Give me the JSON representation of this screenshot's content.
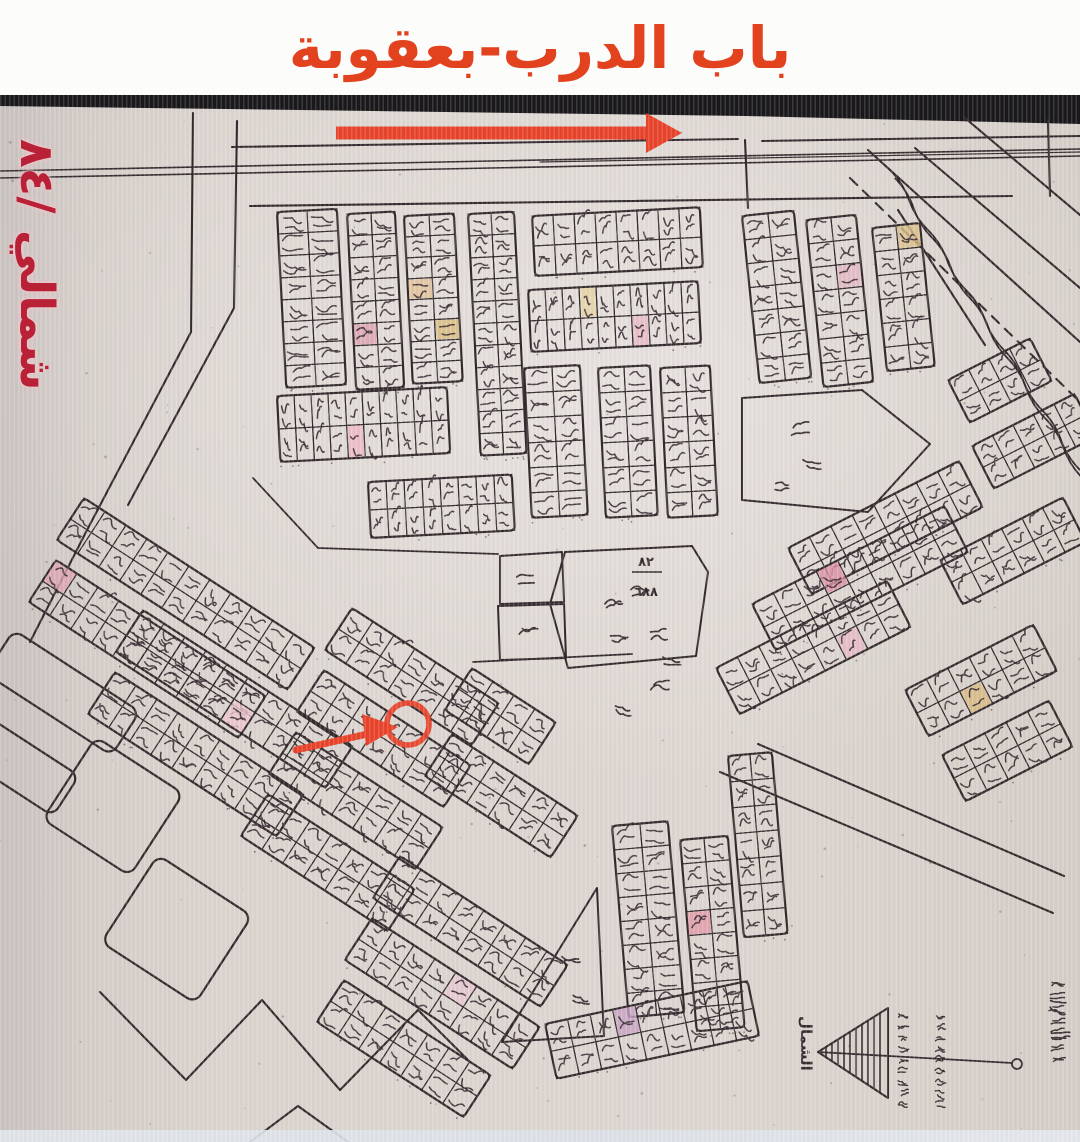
{
  "title": {
    "text": "باب الدرب-بعقوبة"
  },
  "side_label": {
    "text": "شمالي /٨٤"
  },
  "north": {
    "label": "الشمال"
  },
  "center_parcel": {
    "numerator": "٨٢",
    "denominator": "٦٨٨"
  },
  "palette": {
    "title_color": "#e2421e",
    "side_color": "#b92136",
    "annotation_red": "#e8432a",
    "ink": "#332a2d",
    "ink_soft": "#3d3036",
    "paper": "#d9d2cc",
    "top_band": "#19171a"
  },
  "map": {
    "top_band": [
      [
        0,
        95
      ],
      [
        1080,
        95
      ],
      [
        1080,
        124
      ],
      [
        745,
        116
      ],
      [
        0,
        106
      ]
    ],
    "roads": [
      {
        "p": [
          [
            232,
            147
          ],
          [
            738,
            139
          ]
        ]
      },
      {
        "p": [
          [
            762,
            141
          ],
          [
            1080,
            136
          ]
        ]
      },
      {
        "p": [
          [
            0,
            171
          ],
          [
            1080,
            149
          ]
        ],
        "w": 1.6
      },
      {
        "p": [
          [
            0,
            178
          ],
          [
            1080,
            156
          ]
        ],
        "w": 1.6
      },
      {
        "p": [
          [
            540,
            162
          ],
          [
            1080,
            152
          ]
        ],
        "w": 1.2
      },
      {
        "p": [
          [
            193,
            113
          ],
          [
            191,
            332
          ],
          [
            86,
            532
          ],
          [
            30,
            642
          ]
        ]
      },
      {
        "p": [
          [
            237,
            121
          ],
          [
            234,
            308
          ],
          [
            128,
            505
          ]
        ]
      },
      {
        "p": [
          [
            250,
            206
          ],
          [
            1012,
            196
          ]
        ]
      },
      {
        "p": [
          [
            745,
            140
          ],
          [
            748,
            208
          ]
        ]
      },
      {
        "p": [
          [
            1048,
            120
          ],
          [
            1050,
            196
          ]
        ]
      },
      {
        "p": [
          [
            898,
            210
          ],
          [
            985,
            345
          ]
        ]
      },
      {
        "p": [
          [
            868,
            150
          ],
          [
            1080,
            342
          ]
        ]
      },
      {
        "p": [
          [
            915,
            148
          ],
          [
            1080,
            288
          ]
        ]
      },
      {
        "p": [
          [
            965,
            118
          ],
          [
            1080,
            215
          ]
        ]
      },
      {
        "p": [
          [
            850,
            178
          ],
          [
            1080,
            402
          ]
        ],
        "dash": "10 8"
      },
      {
        "p": [
          [
            758,
            744
          ],
          [
            1064,
            876
          ]
        ]
      },
      {
        "p": [
          [
            720,
            772
          ],
          [
            1053,
            913
          ]
        ]
      },
      {
        "p": [
          [
            473,
            662
          ],
          [
            632,
            654
          ]
        ],
        "w": 1.8
      },
      {
        "p": [
          [
            253,
            478
          ],
          [
            318,
            548
          ],
          [
            498,
            554
          ]
        ],
        "w": 1.8
      },
      {
        "p": [
          [
            100,
            992
          ],
          [
            186,
            1080
          ],
          [
            262,
            1000
          ],
          [
            340,
            1090
          ],
          [
            418,
            1010
          ],
          [
            470,
            1062
          ]
        ]
      },
      {
        "p": [
          [
            250,
            1142
          ],
          [
            298,
            1106
          ],
          [
            348,
            1142
          ]
        ]
      }
    ],
    "canal": {
      "from": [
        890,
        170
      ],
      "to": [
        1080,
        470
      ],
      "gap": 8,
      "amp": 4,
      "waves": 10
    },
    "blocks": [
      {
        "x": 277,
        "y": 212,
        "c": 2,
        "r": 8,
        "cw": 30,
        "ch": 22,
        "a": -3
      },
      {
        "x": 347,
        "y": 214,
        "c": 2,
        "r": 8,
        "cw": 24,
        "ch": 22,
        "a": -3
      },
      {
        "x": 404,
        "y": 216,
        "c": 2,
        "r": 8,
        "cw": 25,
        "ch": 21,
        "a": -3
      },
      {
        "x": 468,
        "y": 214,
        "c": 2,
        "r": 11,
        "cw": 23,
        "ch": 22,
        "a": -3
      },
      {
        "x": 532,
        "y": 216,
        "c": 8,
        "r": 2,
        "cw": 21,
        "ch": 30,
        "a": -3
      },
      {
        "x": 528,
        "y": 290,
        "c": 10,
        "r": 2,
        "cw": 17,
        "ch": 31,
        "a": -3
      },
      {
        "x": 524,
        "y": 368,
        "c": 2,
        "r": 6,
        "cw": 28,
        "ch": 25,
        "a": -3
      },
      {
        "x": 598,
        "y": 368,
        "c": 2,
        "r": 6,
        "cw": 26,
        "ch": 25,
        "a": -3
      },
      {
        "x": 660,
        "y": 368,
        "c": 2,
        "r": 6,
        "cw": 25,
        "ch": 25,
        "a": -3
      },
      {
        "x": 277,
        "y": 396,
        "c": 10,
        "r": 2,
        "cw": 17,
        "ch": 33,
        "a": -3
      },
      {
        "x": 368,
        "y": 482,
        "c": 8,
        "r": 2,
        "cw": 18,
        "ch": 28,
        "a": -3
      },
      {
        "x": 742,
        "y": 216,
        "c": 2,
        "r": 7,
        "cw": 26,
        "ch": 24,
        "a": -6
      },
      {
        "x": 806,
        "y": 220,
        "c": 2,
        "r": 7,
        "cw": 25,
        "ch": 24,
        "a": -6
      },
      {
        "x": 872,
        "y": 228,
        "c": 2,
        "r": 6,
        "cw": 24,
        "ch": 24,
        "a": -6
      },
      {
        "x": 788,
        "y": 548,
        "c": 8,
        "r": 2,
        "cw": 24,
        "ch": 26,
        "a": -27
      },
      {
        "x": 752,
        "y": 604,
        "c": 9,
        "r": 2,
        "cw": 24,
        "ch": 26,
        "a": -27
      },
      {
        "x": 716,
        "y": 668,
        "c": 8,
        "r": 2,
        "cw": 24,
        "ch": 26,
        "a": -27
      },
      {
        "x": 940,
        "y": 560,
        "c": 6,
        "r": 2,
        "cw": 23,
        "ch": 25,
        "a": -27
      },
      {
        "x": 972,
        "y": 446,
        "c": 5,
        "r": 2,
        "cw": 23,
        "ch": 24,
        "a": -27
      },
      {
        "x": 905,
        "y": 690,
        "c": 6,
        "r": 2,
        "cw": 24,
        "ch": 26,
        "a": -27
      },
      {
        "x": 942,
        "y": 755,
        "c": 5,
        "r": 2,
        "cw": 24,
        "ch": 26,
        "a": -27
      },
      {
        "x": 84,
        "y": 498,
        "c": 11,
        "r": 2,
        "cw": 25,
        "ch": 25,
        "a": 33
      },
      {
        "x": 56,
        "y": 560,
        "c": 10,
        "r": 2,
        "cw": 25,
        "ch": 25,
        "a": 33
      },
      {
        "x": 143,
        "y": 610,
        "c": 10,
        "r": 2,
        "cw": 25,
        "ch": 25,
        "a": 33
      },
      {
        "x": 115,
        "y": 672,
        "c": 9,
        "r": 2,
        "cw": 25,
        "ch": 25,
        "a": 33
      },
      {
        "x": 352,
        "y": 608,
        "c": 7,
        "r": 2,
        "cw": 25,
        "ch": 25,
        "a": 33
      },
      {
        "x": 324,
        "y": 670,
        "c": 7,
        "r": 2,
        "cw": 25,
        "ch": 25,
        "a": 33
      },
      {
        "x": 296,
        "y": 732,
        "c": 7,
        "r": 2,
        "cw": 25,
        "ch": 25,
        "a": 33
      },
      {
        "x": 268,
        "y": 794,
        "c": 7,
        "r": 2,
        "cw": 25,
        "ch": 25,
        "a": 33
      },
      {
        "x": 472,
        "y": 668,
        "c": 4,
        "r": 2,
        "cw": 25,
        "ch": 25,
        "a": 33
      },
      {
        "x": 452,
        "y": 734,
        "c": 6,
        "r": 2,
        "cw": 25,
        "ch": 25,
        "a": 33
      },
      {
        "x": 400,
        "y": 856,
        "c": 8,
        "r": 2,
        "cw": 25,
        "ch": 25,
        "a": 33
      },
      {
        "x": 372,
        "y": 918,
        "c": 8,
        "r": 2,
        "cw": 25,
        "ch": 25,
        "a": 33
      },
      {
        "x": 344,
        "y": 980,
        "c": 7,
        "r": 2,
        "cw": 25,
        "ch": 25,
        "a": 33
      },
      {
        "x": 612,
        "y": 826,
        "c": 2,
        "r": 8,
        "cw": 28,
        "ch": 24,
        "a": -5
      },
      {
        "x": 680,
        "y": 840,
        "c": 2,
        "r": 8,
        "cw": 24,
        "ch": 24,
        "a": -5
      },
      {
        "x": 728,
        "y": 756,
        "c": 2,
        "r": 7,
        "cw": 22,
        "ch": 26,
        "a": -5
      },
      {
        "x": 545,
        "y": 1024,
        "c": 9,
        "r": 2,
        "cw": 23,
        "ch": 28,
        "a": -12
      },
      {
        "x": 948,
        "y": 380,
        "c": 4,
        "r": 2,
        "cw": 23,
        "ch": 24,
        "a": -27
      }
    ],
    "tints": [
      {
        "b": 1,
        "c": 0,
        "r": 5,
        "col": "#dfa3b0"
      },
      {
        "b": 2,
        "c": 1,
        "r": 5,
        "col": "#d9bd7e"
      },
      {
        "b": 2,
        "c": 0,
        "r": 3,
        "col": "#e2c398"
      },
      {
        "b": 5,
        "c": 3,
        "r": 0,
        "col": "#e6d5a4"
      },
      {
        "b": 5,
        "c": 6,
        "r": 1,
        "col": "#eab9c5"
      },
      {
        "b": 9,
        "c": 4,
        "r": 1,
        "col": "#efb9c6"
      },
      {
        "b": 12,
        "c": 1,
        "r": 2,
        "col": "#e4b9c3"
      },
      {
        "b": 13,
        "c": 1,
        "r": 0,
        "col": "#dcc08a"
      },
      {
        "b": 15,
        "c": 3,
        "r": 0,
        "col": "#dd8fa3"
      },
      {
        "b": 16,
        "c": 5,
        "r": 1,
        "col": "#e9bac6"
      },
      {
        "b": 19,
        "c": 2,
        "r": 1,
        "col": "#d9b97e"
      },
      {
        "b": 22,
        "c": 0,
        "r": 0,
        "col": "#dfa4b2"
      },
      {
        "b": 23,
        "c": 5,
        "r": 1,
        "col": "#eec5ce"
      },
      {
        "b": 32,
        "c": 4,
        "r": 0,
        "col": "#e8c9d2"
      },
      {
        "b": 35,
        "c": 0,
        "r": 3,
        "col": "#e49aa8"
      },
      {
        "b": 37,
        "c": 3,
        "r": 0,
        "col": "#c9a3c4"
      }
    ],
    "parcels": [
      {
        "x": 14,
        "y": 630,
        "w": 150,
        "h": 52,
        "a": 33
      },
      {
        "x": -30,
        "y": 705,
        "w": 130,
        "h": 48,
        "a": 33
      },
      {
        "x": 96,
        "y": 737,
        "w": 104,
        "h": 98,
        "a": 33
      },
      {
        "x": 158,
        "y": 855,
        "w": 112,
        "h": 104,
        "a": 33
      }
    ],
    "polygons": [
      {
        "pts": [
          [
            565,
            552
          ],
          [
            692,
            546
          ],
          [
            708,
            572
          ],
          [
            696,
            656
          ],
          [
            568,
            668
          ],
          [
            550,
            604
          ]
        ]
      },
      {
        "pts": [
          [
            742,
            398
          ],
          [
            862,
            390
          ],
          [
            930,
            444
          ],
          [
            868,
            512
          ],
          [
            742,
            500
          ]
        ]
      },
      {
        "pts": [
          [
            597,
            888
          ],
          [
            604,
            1036
          ],
          [
            502,
            1042
          ]
        ]
      },
      {
        "pts": [
          [
            500,
            556
          ],
          [
            562,
            552
          ],
          [
            564,
            602
          ],
          [
            500,
            604
          ]
        ]
      },
      {
        "pts": [
          [
            498,
            606
          ],
          [
            564,
            604
          ],
          [
            566,
            658
          ],
          [
            500,
            660
          ]
        ]
      }
    ],
    "marks": [
      [
        600,
        598
      ],
      [
        628,
        584
      ],
      [
        606,
        630
      ],
      [
        512,
        572
      ],
      [
        516,
        624
      ],
      [
        788,
        424
      ],
      [
        800,
        454
      ],
      [
        768,
        478
      ],
      [
        558,
        952
      ],
      [
        568,
        990
      ],
      [
        646,
        628
      ],
      [
        660,
        652
      ],
      [
        648,
        680
      ],
      [
        610,
        700
      ],
      [
        1044,
        996
      ],
      [
        1048,
        1028
      ]
    ],
    "fraction_pos": {
      "x": 646,
      "y1": 566,
      "y2": 584,
      "line": [
        632,
        572,
        662,
        572
      ]
    },
    "marker": {
      "cx": 408,
      "cy": 724,
      "r": 21,
      "tail": [
        296,
        750
      ],
      "tip": [
        398,
        727
      ]
    },
    "top_arrow": {
      "x1": 336,
      "x2": 646,
      "y": 133,
      "shaft": 13,
      "head_len": 36,
      "head_w": 40
    },
    "north_symbol": {
      "apex": [
        818,
        1052
      ],
      "top": [
        888,
        1008
      ],
      "bot": [
        888,
        1098
      ],
      "line_end": [
        1012,
        1063
      ],
      "loop": [
        1017,
        1064
      ],
      "label_pos": [
        801,
        1016
      ],
      "text_cols": [
        896,
        933
      ],
      "signature": [
        1046,
        978
      ]
    },
    "speckles": {
      "count": 170
    }
  }
}
